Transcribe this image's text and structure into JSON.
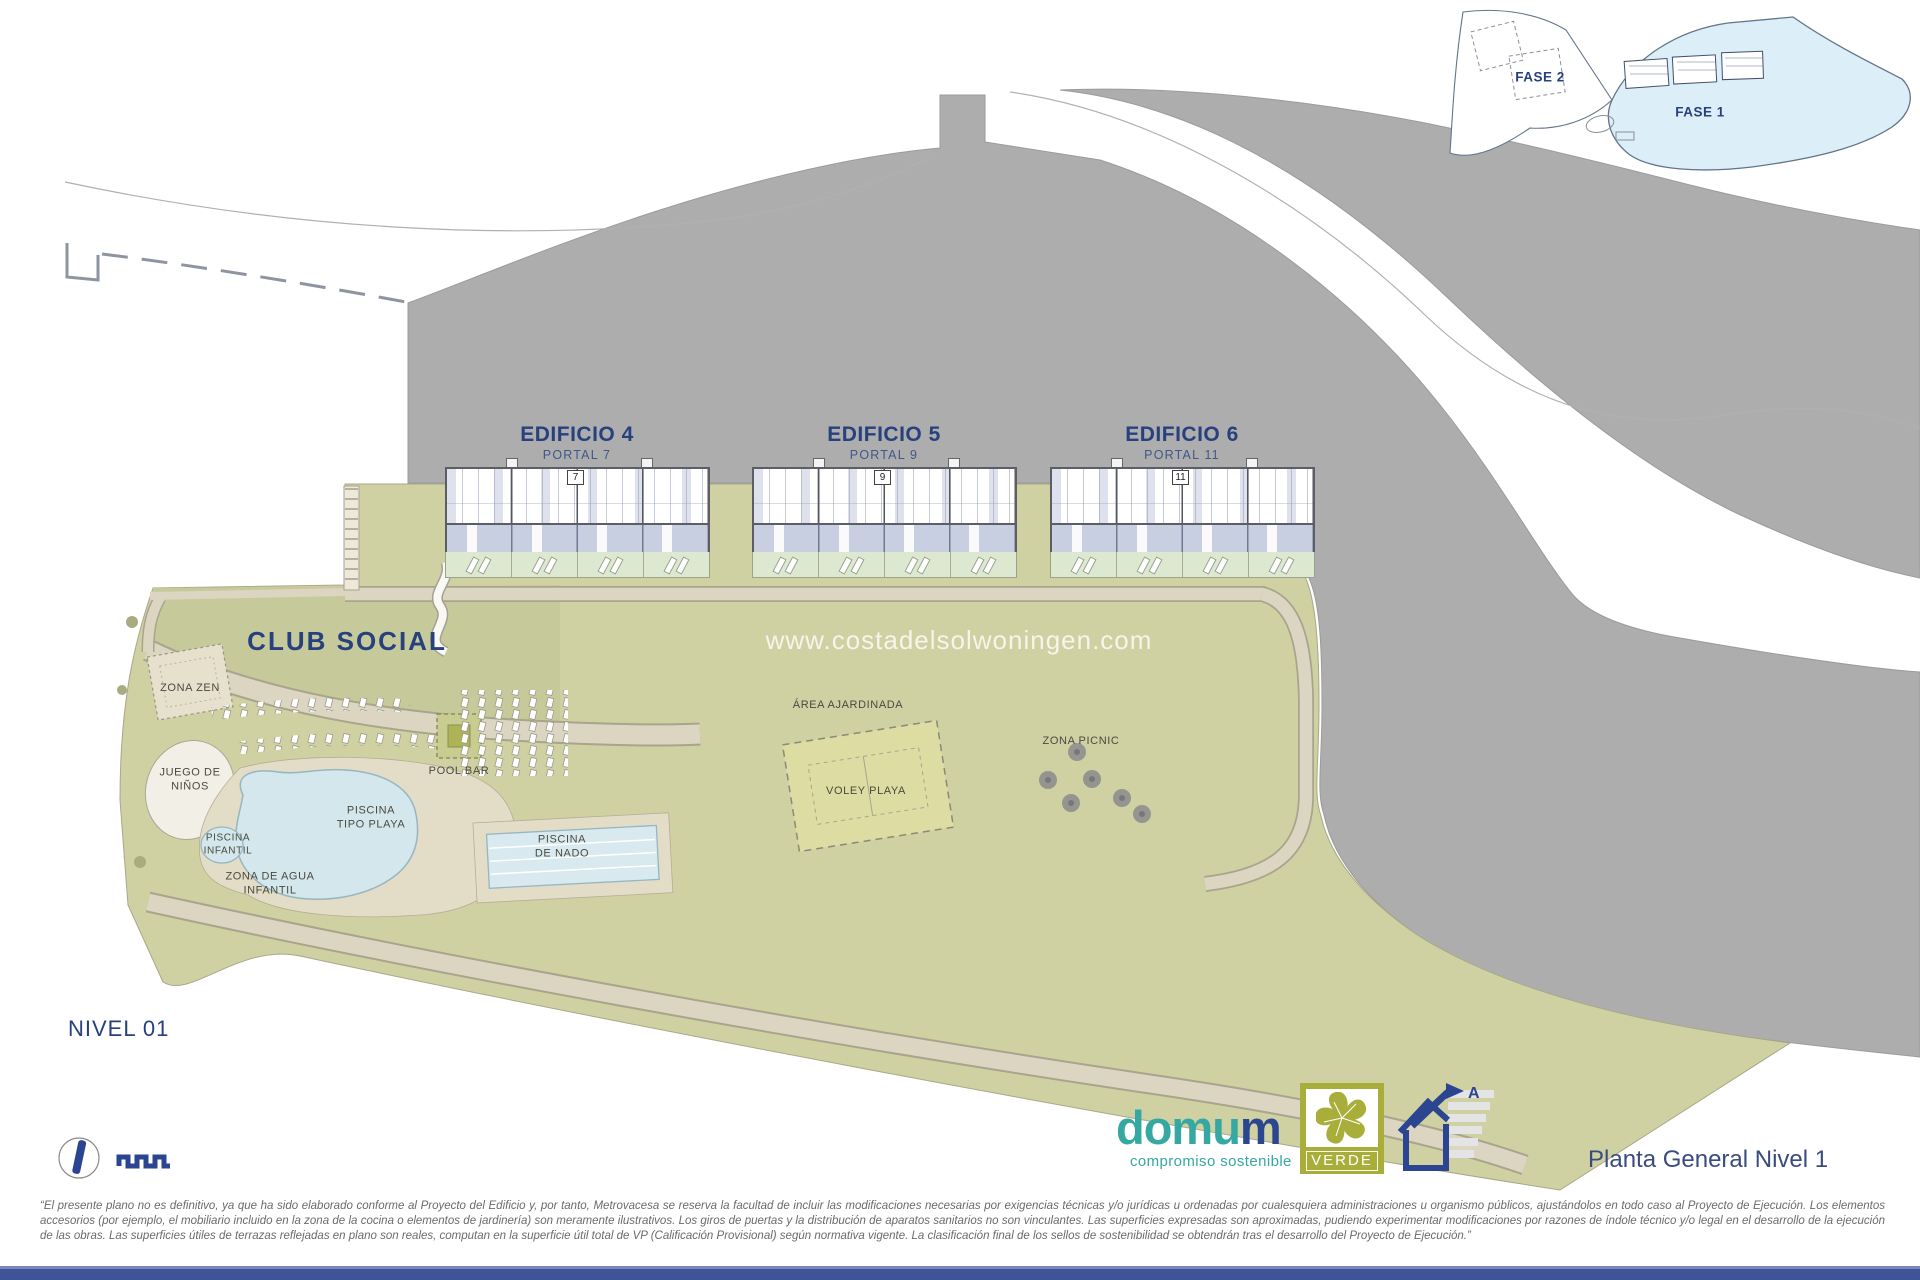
{
  "inset": {
    "fase1_label": "FASE 1",
    "fase2_label": "FASE 2"
  },
  "buildings": [
    {
      "name": "EDIFICIO 4",
      "portal": "PORTAL 7",
      "number": "7"
    },
    {
      "name": "EDIFICIO 5",
      "portal": "PORTAL 9",
      "number": "9"
    },
    {
      "name": "EDIFICIO 6",
      "portal": "PORTAL 11",
      "number": "11"
    }
  ],
  "site_labels": {
    "club_social": "CLUB SOCIAL",
    "zona_zen": "ZONA ZEN",
    "juego_ninos": [
      "JUEGO DE",
      "NIÑOS"
    ],
    "piscina_infantil": [
      "PISCINA",
      "INFANTIL"
    ],
    "zona_agua": [
      "ZONA DE AGUA",
      "INFANTIL"
    ],
    "piscina_tipo_playa": [
      "PISCINA",
      "TIPO PLAYA"
    ],
    "pool_bar": "POOL BAR",
    "piscina_nado": [
      "PISCINA",
      "DE NADO"
    ],
    "area_ajardinada": "ÁREA AJARDINADA",
    "voley_playa": "VOLEY PLAYA",
    "zona_picnic": "ZONA PICNIC"
  },
  "watermark": "www.costadelsolwoningen.com",
  "level_label": "NIVEL 01",
  "footer": {
    "brand_part1": "domu",
    "brand_part2": "m",
    "tagline": "compromiso sostenible",
    "verde_label": "VERDE",
    "energy_rating": "A",
    "plan_title": "Planta General Nivel 1",
    "disclaimer": "“El presente plano no es definitivo, ya que ha sido elaborado conforme al Proyecto del Edificio y, por tanto, Metrovacesa se reserva la facultad de incluir las modificaciones necesarias por exigencias técnicas y/o jurídicas u ordenadas por cualesquiera administraciones u organismo públicos, ajustándolos en todo caso al Proyecto de Ejecución. Los elementos accesorios (por ejemplo, el mobiliario incluido en la zona de la cocina o elementos de jardinería) son meramente ilustrativos. Los giros de puertas y la distribución de aparatos sanitarios no son vinculantes. Las superficies expresadas son aproximadas, pudiendo experimentar modificaciones por razones de índole técnico y/o legal en el desarrollo de la ejecución de las obras. Las superficies útiles de terrazas reflejadas en plano son reales, computan en la superficie útil total de VP (Calificación Provisional) según normativa vigente. La clasificación final de los sellos de sostenibilidad se obtendrán tras el desarrollo del Proyecto de Ejecución.”"
  },
  "colors": {
    "gray_terrain": "#ADADAD",
    "site_green": "#CFD1A2",
    "club_lawn": "#C6CA9A",
    "path_beige": "#DBD5C1",
    "pool_water": "#D3E7EC",
    "sand": "#E3DCC7",
    "navy": "#27407E",
    "teal": "#35A8A2",
    "verde_olive": "#A9AE3B",
    "bottom_bar": "#3F5498",
    "fase1_fill": "#DCEEF7"
  }
}
